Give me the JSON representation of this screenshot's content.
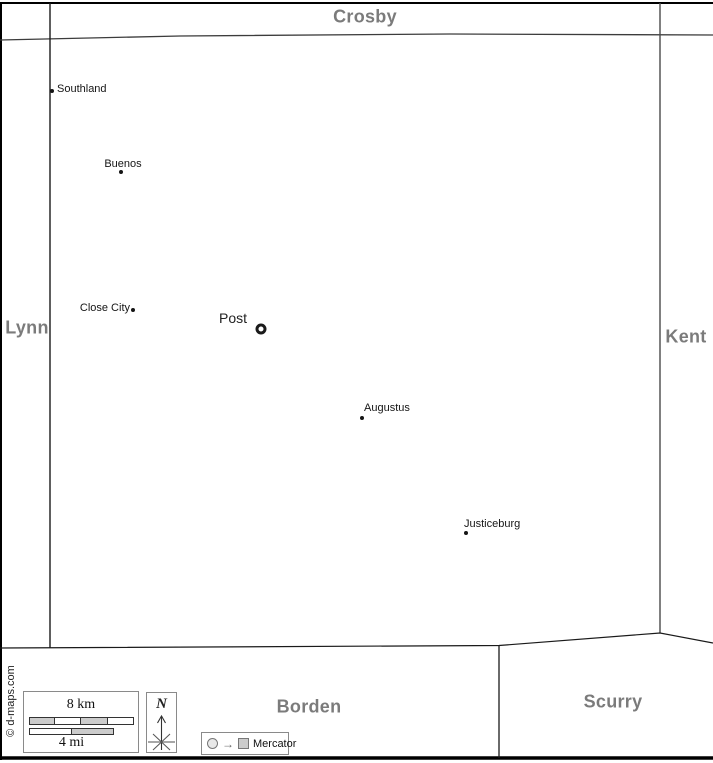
{
  "counties": {
    "north": "Crosby",
    "west": "Lynn",
    "east": "Kent",
    "southwest": "Borden",
    "southeast": "Scurry"
  },
  "towns": [
    {
      "name": "Southland",
      "marker": "dot"
    },
    {
      "name": "Buenos",
      "marker": "dot"
    },
    {
      "name": "Close City",
      "marker": "dot"
    },
    {
      "name": "Post",
      "marker": "county-seat-ring"
    },
    {
      "name": "Augustus",
      "marker": "dot"
    },
    {
      "name": "Justiceburg",
      "marker": "dot"
    }
  ],
  "legend": {
    "scale_km_label": "8 km",
    "scale_mi_label": "4 mi",
    "north_label": "N",
    "projection_label": "Mercator",
    "projection_arrow": "→",
    "copyright": "© d-maps.com"
  },
  "colors": {
    "county_label": "#7b7b7b",
    "boundary_line": "#1a1a1a",
    "scale_segment_fill": "#cccccc",
    "background": "#ffffff"
  }
}
